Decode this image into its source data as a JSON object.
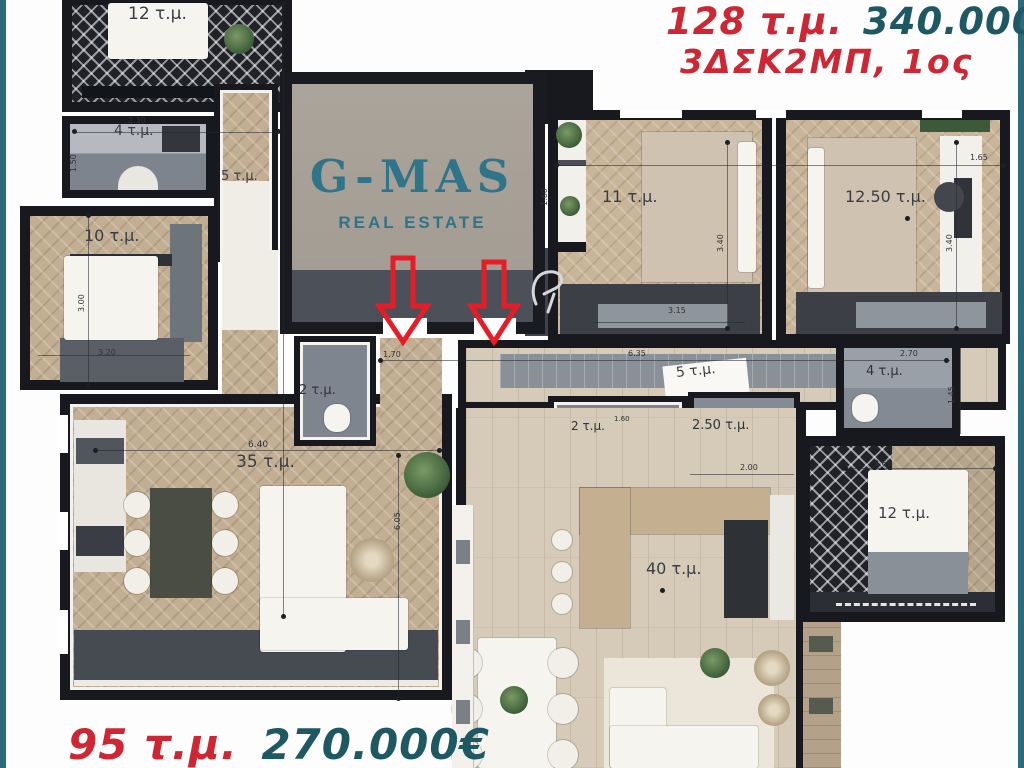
{
  "colors": {
    "accent_red": "#ce2733",
    "accent_teal": "#1d5863",
    "logo_teal": "#2f7488",
    "frame_teal": "#2d6a7b",
    "wall": "#17191e"
  },
  "listing_top": {
    "area": "128 τ.μ.",
    "price": "340.000€",
    "layout_floor": "3ΔΣΚ2ΜΠ, 1ος"
  },
  "listing_bottom": {
    "area": "95 τ.μ.",
    "price": "270.000€"
  },
  "logo": {
    "name": "G-MAS",
    "tagline": "REAL ESTATE"
  },
  "apartment_95": {
    "rooms": {
      "bedroom_top": "12 τ.μ.",
      "bath": "4 τ.μ.",
      "hallway": "5 τ.μ.",
      "bedroom": "10 τ.μ.",
      "wc": "2 τ.μ.",
      "living": "35 τ.μ."
    },
    "dims": {
      "bath_width": "2.30",
      "bath_height": "1.50",
      "bedroom_height": "3.00",
      "bedroom_width": "3.20",
      "living_width": "6.40",
      "hall_width": "1.70",
      "hall_length": "6.05"
    }
  },
  "apartment_128": {
    "rooms": {
      "bedroom_a": "11 τ.μ.",
      "bedroom_b": "12.50 τ.μ.",
      "hallway": "5 τ.μ.",
      "bath_a": "2 τ.μ.",
      "bath_b": "2.50 τ.μ.",
      "bath_c": "4 τ.μ.",
      "bedroom_c": "12 τ.μ.",
      "living": "40 τ.μ."
    },
    "dims": {
      "balcony_width": "1.60",
      "bedroom_a_height": "3.40",
      "bedroom_a_width": "3.15",
      "bedroom_b_height": "3.40",
      "bedroom_b_edge": "1.65",
      "hall_length": "6.35",
      "bath_a_width": "1.60",
      "bath_b_width": "2.00",
      "bath_c_width": "2.70",
      "bath_c_height": "1.45",
      "bedroom_c_width": "3.65"
    }
  }
}
